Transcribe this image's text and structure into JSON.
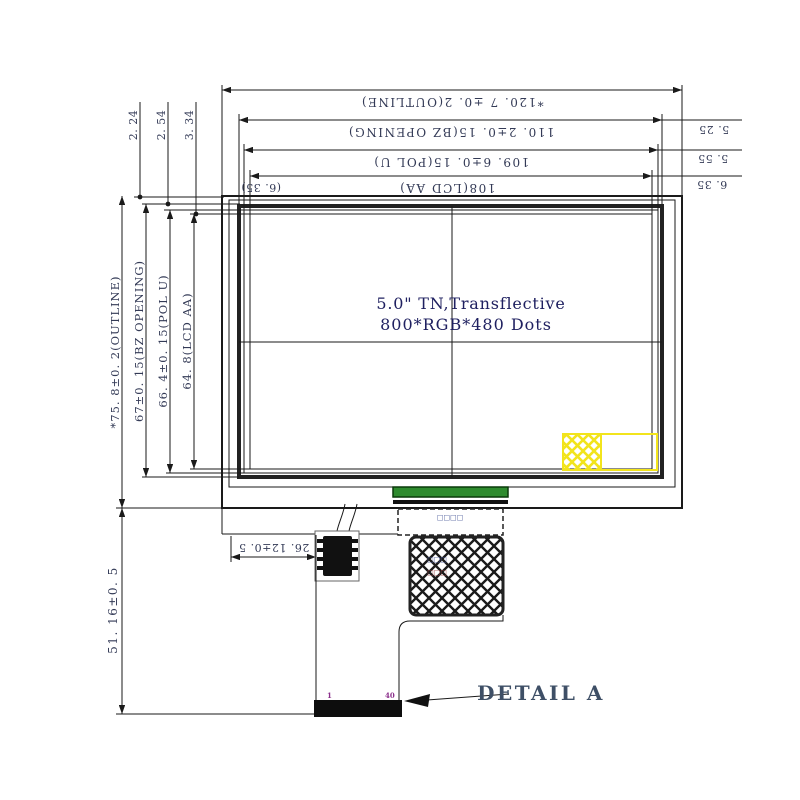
{
  "drawing": {
    "panel": {
      "title_line1": "5.0\" TN,Transflective",
      "title_line2": "800*RGB*480 Dots"
    },
    "dims": {
      "top": [
        "*120. 7 ±0. 2(OUTLINE)",
        "110. 2±0. 15(BZ OPENING)",
        "109. 6±0. 15(POL U)",
        "108(LCD AA)"
      ],
      "top_left_paren": "(6. 35)",
      "right_offsets": [
        "5. 25",
        "5. 55",
        "6. 35"
      ],
      "top_small_offsets": [
        "2. 24",
        "2. 54",
        "3. 34"
      ],
      "left": [
        "*75. 8±0. 2(OUTLINE)",
        "67±0. 15(BZ OPENING)",
        "66. 4±0. 15(POL U)",
        "64. 8(LCD AA)"
      ],
      "fpc_height": "51. 16±0. 5",
      "fpc_offset": "26. 12±0. 5"
    },
    "detail": {
      "label": "DETAIL A",
      "pin_first": "1",
      "pin_last": "40"
    },
    "annotations": {
      "stiffener_text": "□□□□",
      "hatch_text_1": "□□□",
      "hatch_text_2": "□□□"
    },
    "colors": {
      "line": "#1a1a1a",
      "dim_text": "#333a56",
      "title_text": "#1f2060",
      "highlight_yellow": "#f2e41c",
      "connector_green": "#2e8b2e",
      "pin_purple": "#8b2f8b",
      "detail_text": "#3e4f66"
    }
  }
}
